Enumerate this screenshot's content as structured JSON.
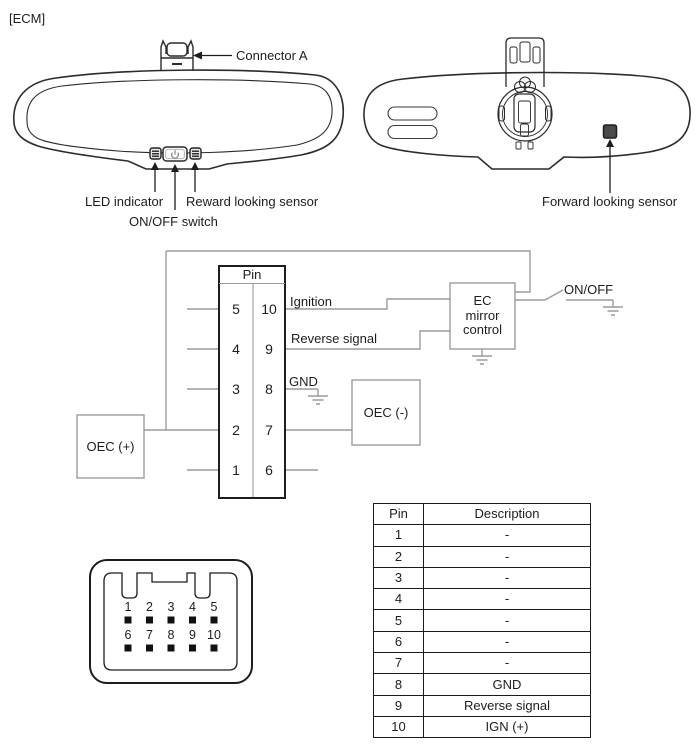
{
  "page": {
    "tag": "[ECM]"
  },
  "front_mirror": {
    "connector_label": "Connector A",
    "led_label": "LED indicator",
    "switch_label": "ON/OFF switch",
    "rear_sensor_label": "Reward looking sensor"
  },
  "rear_mirror": {
    "sensor_label": "Forward looking sensor"
  },
  "schematic": {
    "pin_header": "Pin",
    "left_pins": [
      "5",
      "4",
      "3",
      "2",
      "1"
    ],
    "right_pins": [
      "10",
      "9",
      "8",
      "7",
      "6"
    ],
    "labels": {
      "ignition": "Ignition",
      "reverse": "Reverse signal",
      "gnd": "GND",
      "oec_plus": "OEC (+)",
      "oec_minus": "OEC (-)",
      "ec1": "EC",
      "ec2": "mirror",
      "ec3": "control",
      "on_off": "ON/OFF"
    }
  },
  "connector_view": {
    "row1": [
      "1",
      "2",
      "3",
      "4",
      "5"
    ],
    "row2": [
      "6",
      "7",
      "8",
      "9",
      "10"
    ]
  },
  "pin_table": {
    "headers": [
      "Pin",
      "Description"
    ],
    "rows": [
      [
        "1",
        "-"
      ],
      [
        "2",
        "-"
      ],
      [
        "3",
        "-"
      ],
      [
        "4",
        "-"
      ],
      [
        "5",
        "-"
      ],
      [
        "6",
        "-"
      ],
      [
        "7",
        "-"
      ],
      [
        "8",
        "GND"
      ],
      [
        "9",
        "Reverse signal"
      ],
      [
        "10",
        "IGN (+)"
      ]
    ]
  },
  "colors": {
    "line": "#2b2b2b",
    "wire": "#9c9c9c",
    "background": "#ffffff"
  }
}
